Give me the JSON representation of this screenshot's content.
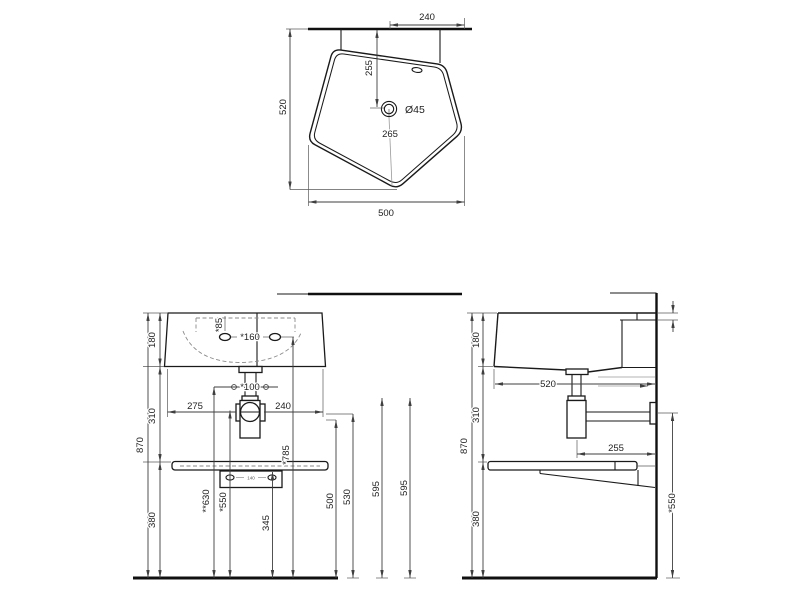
{
  "drawing": {
    "background": "#ffffff",
    "object_line_color": "#1a1a1a",
    "dimension_color": "#3f3f3f"
  },
  "top_view": {
    "faucet_offset": "240",
    "depth": "520",
    "drain_from_wall": "255",
    "drain_diameter": "Ø45",
    "drain_from_front": "265",
    "width": "500"
  },
  "front_view": {
    "basin_height": "180",
    "basin_to_shelf": "310",
    "total_height": "870",
    "shelf_to_floor": "380",
    "hole_offset": "*85",
    "hole_spacing": "*160",
    "supply_spacing": "*100",
    "left_to_trap": "275",
    "trap_to_right": "240",
    "rim_height": "*785",
    "supply_height": "**630",
    "trap_height": "*550",
    "bracket_height": "345",
    "outlet_height_a": "500",
    "outlet_height_b": "530",
    "ref_height_a": "595",
    "ref_height_b": "595",
    "bracket_hole_spacing": "140"
  },
  "side_view": {
    "basin_height": "180",
    "basin_to_shelf": "310",
    "total_height": "870",
    "shelf_to_floor": "380",
    "depth": "520",
    "trap_to_wall": "255",
    "trap_height": "*550"
  }
}
